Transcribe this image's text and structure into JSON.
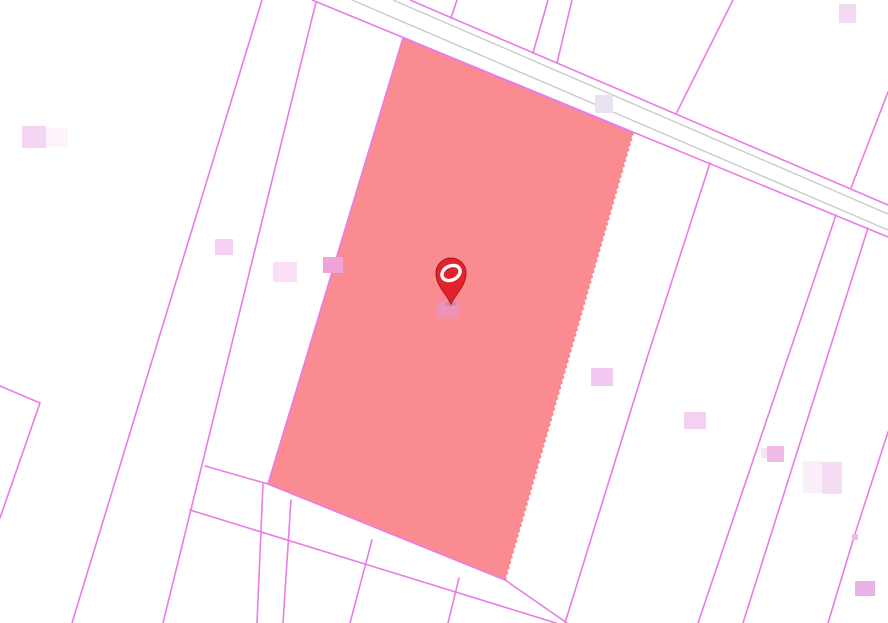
{
  "map": {
    "width": 888,
    "height": 623,
    "background_color": "#ffffff",
    "colors": {
      "parcel_boundary": "#e87de4",
      "road_casing": "#cccccc",
      "highlight_fill": "#fa868d",
      "highlight_dotted_edge": "#fa868d",
      "marker_red": "#e2232b",
      "marker_dark_red": "#a8161d",
      "marker_glyph_white": "#ffffff"
    },
    "stroke_widths": {
      "parcel_boundary": 1.6,
      "road_casing": 1.4,
      "highlight_edge": 1.7
    },
    "road": {
      "edges": [
        "410,0 888,205",
        "312,0 888,237"
      ],
      "casings": [
        "393,0 888,214",
        "352,0 888,230"
      ]
    },
    "parcel_lines": [
      "262,0 72,623",
      "316,2 163,623",
      "457,0 451,18",
      "548,0 533,53",
      "572,0 557,63",
      "733,0 676,114",
      "888,92 851,188",
      "0,386 40,403 0,518",
      "205,466 268,484",
      "190,510 556,623",
      "505,580 567,623",
      "263,484 257,623",
      "291,500 283,623",
      "372,540 350,623",
      "459,578 448,623",
      "710,163 648,355 565,623",
      "836,215 698,623",
      "868,228 743,623",
      "888,432 854,537 828,623"
    ],
    "highlighted_parcel": {
      "polygon": "403,38 633,133 505,580 268,484",
      "solid_edges": "633,133 403,38 268,484 505,580",
      "dotted_edge": "633,133 505,580"
    },
    "buildings": [
      {
        "x": 22,
        "y": 126,
        "w": 24,
        "h": 22,
        "color": "#f4d6f3"
      },
      {
        "x": 46,
        "y": 128,
        "w": 22,
        "h": 19,
        "color": "#fdf3fc"
      },
      {
        "x": 215,
        "y": 239,
        "w": 18,
        "h": 16,
        "color": "#f6d0f4"
      },
      {
        "x": 273,
        "y": 262,
        "w": 24,
        "h": 20,
        "color": "#f9e0f6"
      },
      {
        "x": 323,
        "y": 257,
        "w": 20,
        "h": 16,
        "color": "#efa3d8"
      },
      {
        "x": 437,
        "y": 302,
        "w": 23,
        "h": 16,
        "color": "#ec92b7"
      },
      {
        "x": 595,
        "y": 95,
        "w": 18,
        "h": 18,
        "color": "#e9e2f0"
      },
      {
        "x": 839,
        "y": 4,
        "w": 17,
        "h": 19,
        "color": "#f3daf3"
      },
      {
        "x": 591,
        "y": 368,
        "w": 22,
        "h": 18,
        "color": "#f3c9f1"
      },
      {
        "x": 684,
        "y": 412,
        "w": 22,
        "h": 17,
        "color": "#f4d0f2"
      },
      {
        "x": 761,
        "y": 448,
        "w": 6,
        "h": 10,
        "color": "#f6e2f4"
      },
      {
        "x": 767,
        "y": 446,
        "w": 17,
        "h": 16,
        "color": "#eebbe9"
      },
      {
        "x": 803,
        "y": 461,
        "w": 19,
        "h": 32,
        "color": "#faeefa"
      },
      {
        "x": 822,
        "y": 462,
        "w": 20,
        "h": 32,
        "color": "#f5ddf4"
      },
      {
        "x": 852,
        "y": 534,
        "w": 6,
        "h": 6,
        "color": "#edbdea"
      },
      {
        "x": 855,
        "y": 581,
        "w": 20,
        "h": 15,
        "color": "#eab3e8"
      }
    ],
    "marker": {
      "tip_x": 451,
      "tip_y": 304,
      "head_cx": 451,
      "head_cy": 273,
      "head_r": 15,
      "glyph_rx": 9.5,
      "glyph_ry": 7,
      "glyph_rotation": -26,
      "glyph_stroke_width": 3.4
    }
  }
}
